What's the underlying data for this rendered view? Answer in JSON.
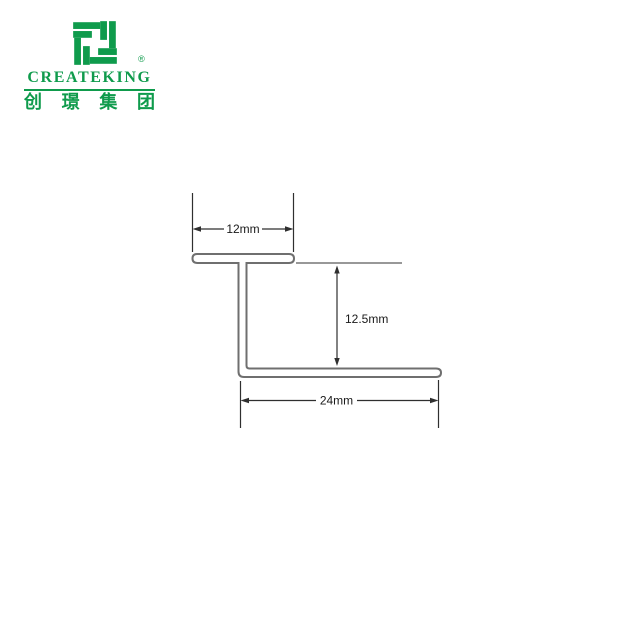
{
  "brand": {
    "name": "CREATEKING",
    "registered_mark": "®",
    "chinese_name": "创璟集团",
    "chinese_chars": [
      "创",
      "璟",
      "集",
      "团"
    ],
    "color": "#0f9b4c"
  },
  "diagram": {
    "labels": {
      "top_width": "12mm",
      "height": "12.5mm",
      "bottom_width": "24mm"
    },
    "profile_line_color": "#6f6f6f",
    "reference_line_color": "#777777",
    "dimension_line_color": "#2f2f2f"
  }
}
